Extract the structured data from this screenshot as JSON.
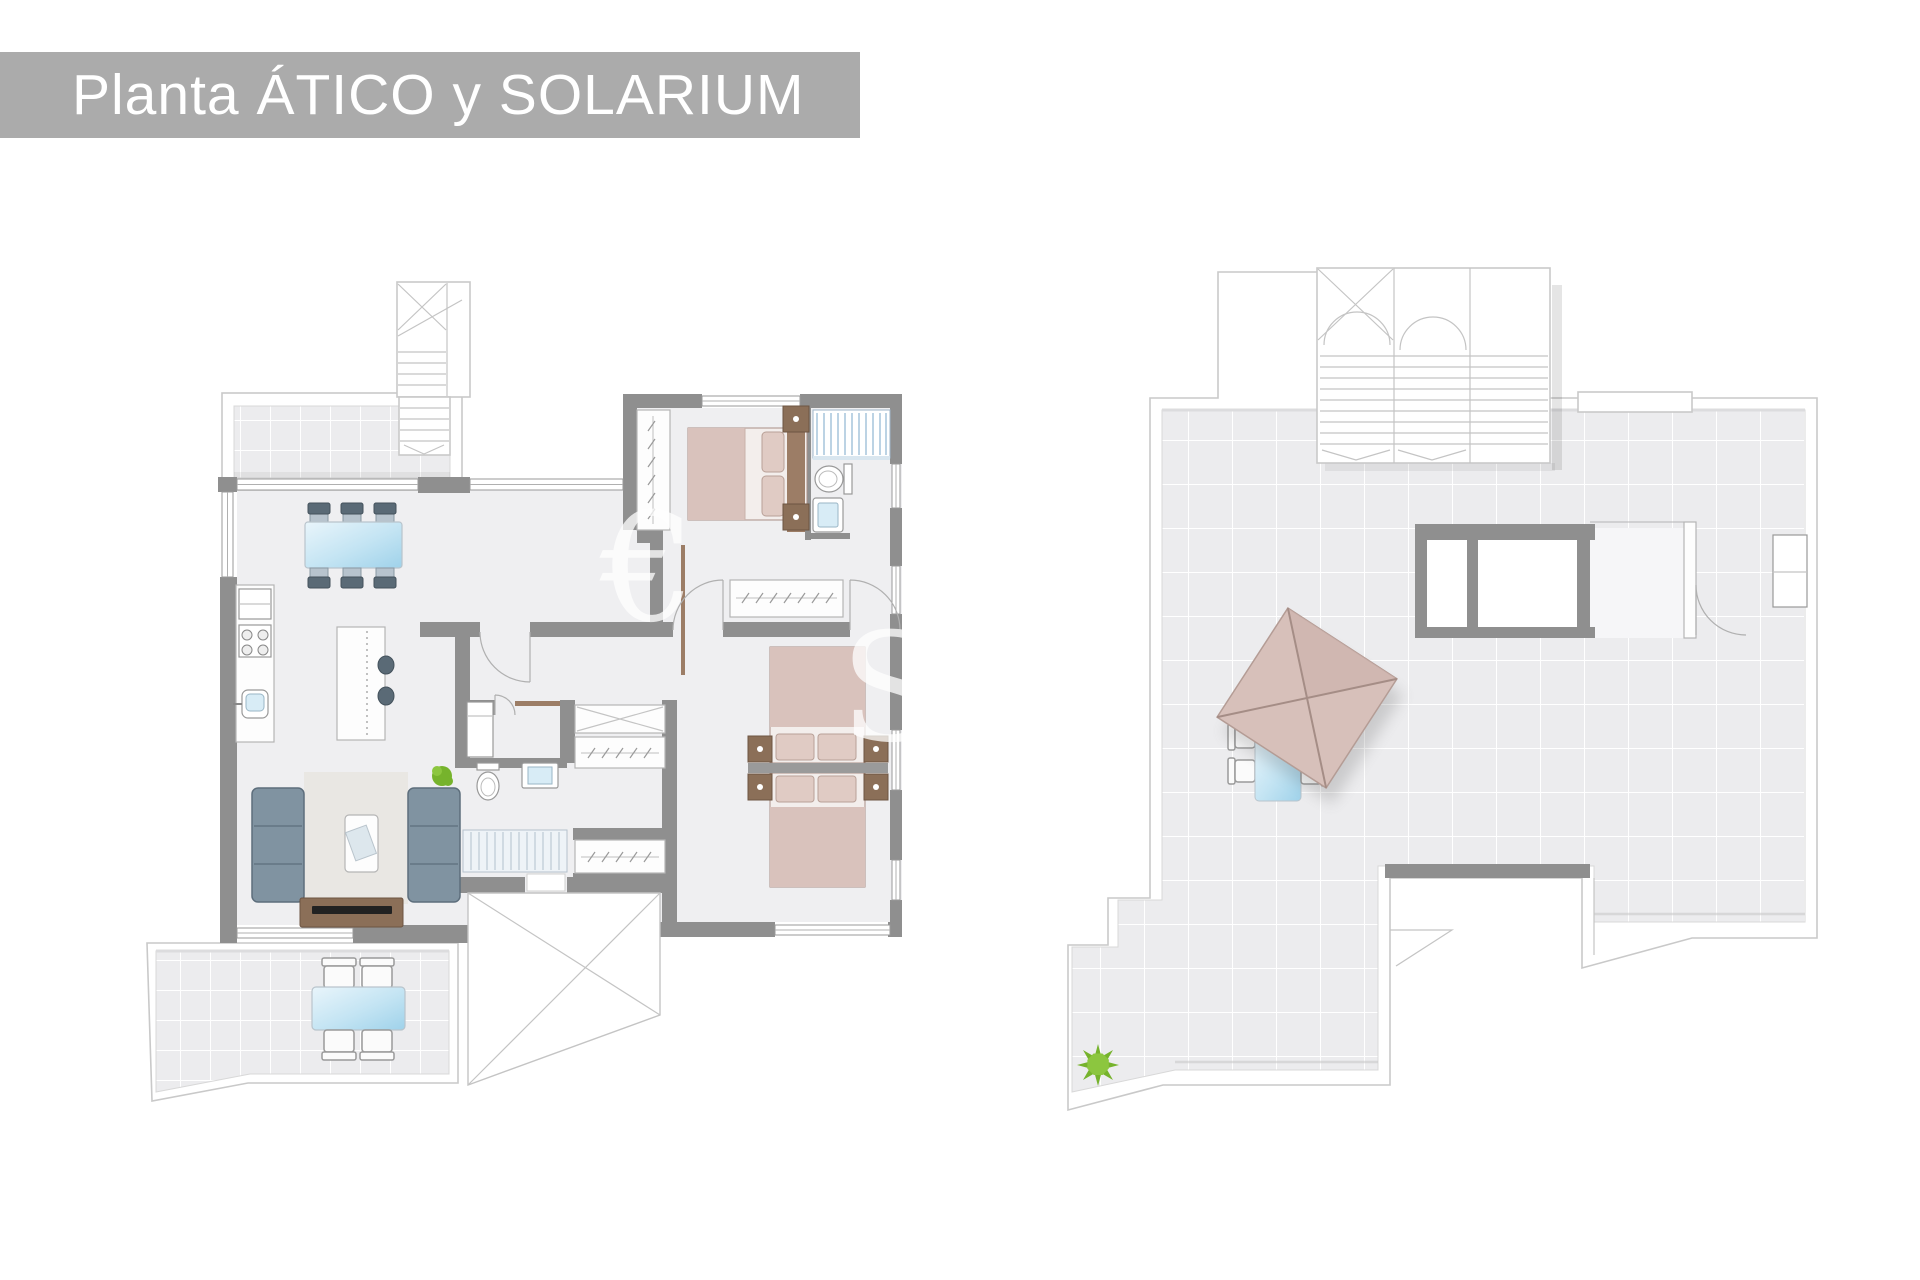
{
  "title_bar": {
    "label": "Planta ÁTICO y SOLARIUM"
  },
  "watermark": {
    "eur": "€",
    "s": "S"
  },
  "plans": {
    "left": {
      "name": "atico-floor-plan"
    },
    "right": {
      "name": "solarium-roof-plan"
    }
  },
  "colors": {
    "title_bar": "#ababab",
    "title_text": "#ffffff",
    "wall": "#8f8f8f",
    "wall_light": "#b5b5b5",
    "outline": "#c9c9c9",
    "floor": "#efeff1",
    "tile": "#ececee",
    "tile_line": "#ffffff",
    "bed_pink": "#d9c2bc",
    "bed_pink_dark": "#a98f86",
    "wood_brown": "#8b6f58",
    "wood_dark": "#6d5442",
    "sofa_blue": "#8093a1",
    "sofa_dark": "#5d6e7c",
    "umbrella_pink": "#d7c0ba",
    "umbrella_line": "#a58d86",
    "plant_green": "#76b32c"
  }
}
